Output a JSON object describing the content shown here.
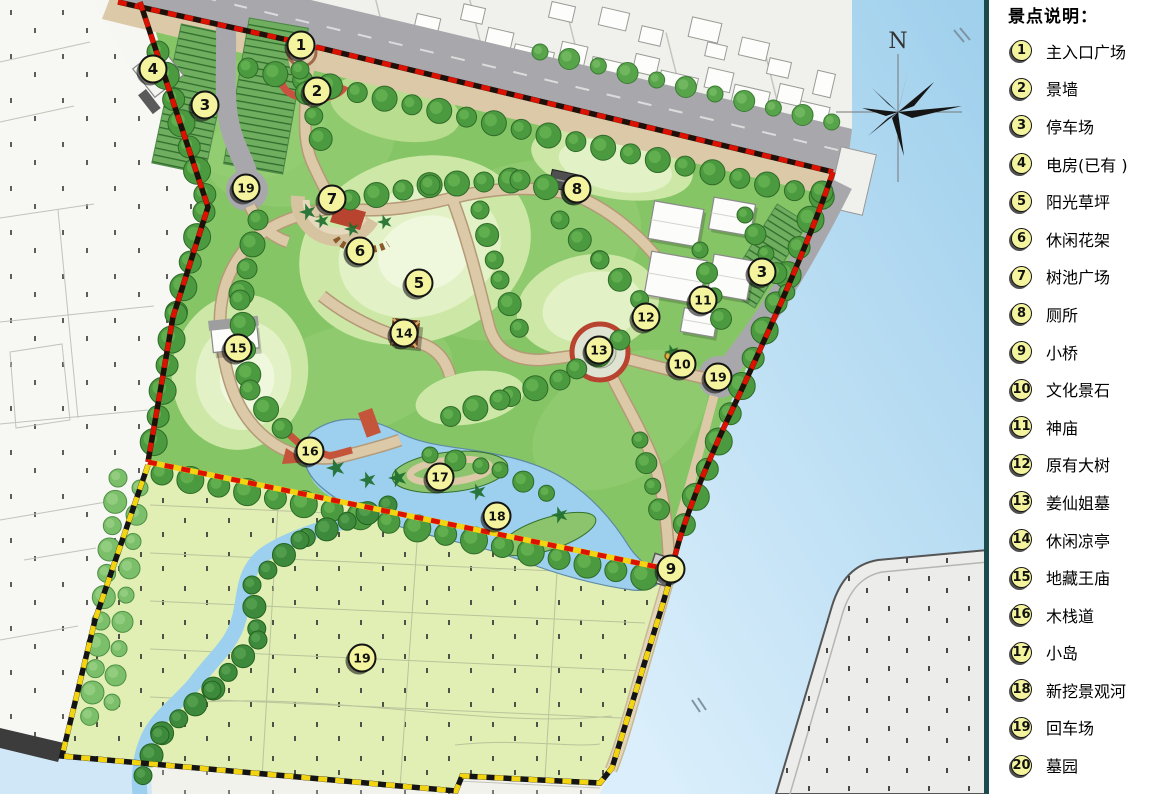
{
  "legend": {
    "title": "景点说明：",
    "items": [
      {
        "num": "1",
        "label": "主入口广场"
      },
      {
        "num": "2",
        "label": "景墙"
      },
      {
        "num": "3",
        "label": "停车场"
      },
      {
        "num": "4",
        "label": "电房(已有 )"
      },
      {
        "num": "5",
        "label": "阳光草坪"
      },
      {
        "num": "6",
        "label": "休闲花架"
      },
      {
        "num": "7",
        "label": "树池广场"
      },
      {
        "num": "8",
        "label": "厕所"
      },
      {
        "num": "9",
        "label": "小桥"
      },
      {
        "num": "10",
        "label": "文化景石"
      },
      {
        "num": "11",
        "label": "神庙"
      },
      {
        "num": "12",
        "label": "原有大树"
      },
      {
        "num": "13",
        "label": "姜仙姐墓"
      },
      {
        "num": "14",
        "label": "休闲凉亭"
      },
      {
        "num": "15",
        "label": "地藏王庙"
      },
      {
        "num": "16",
        "label": "木栈道"
      },
      {
        "num": "17",
        "label": "小岛"
      },
      {
        "num": "18",
        "label": "新挖景观河"
      },
      {
        "num": "19",
        "label": "回车场"
      },
      {
        "num": "20",
        "label": "墓园"
      }
    ]
  },
  "map": {
    "compass_label": "N",
    "markers": [
      {
        "num": "1",
        "x": 301,
        "y": 45
      },
      {
        "num": "2",
        "x": 317,
        "y": 91
      },
      {
        "num": "3",
        "x": 205,
        "y": 105
      },
      {
        "num": "4",
        "x": 153,
        "y": 69
      },
      {
        "num": "19",
        "x": 246,
        "y": 188
      },
      {
        "num": "7",
        "x": 332,
        "y": 199
      },
      {
        "num": "8",
        "x": 577,
        "y": 189
      },
      {
        "num": "6",
        "x": 360,
        "y": 251
      },
      {
        "num": "5",
        "x": 419,
        "y": 283
      },
      {
        "num": "3",
        "x": 762,
        "y": 272
      },
      {
        "num": "11",
        "x": 703,
        "y": 300
      },
      {
        "num": "12",
        "x": 646,
        "y": 317
      },
      {
        "num": "14",
        "x": 404,
        "y": 333
      },
      {
        "num": "13",
        "x": 599,
        "y": 350
      },
      {
        "num": "10",
        "x": 682,
        "y": 364
      },
      {
        "num": "19",
        "x": 718,
        "y": 377
      },
      {
        "num": "15",
        "x": 238,
        "y": 348
      },
      {
        "num": "16",
        "x": 310,
        "y": 451
      },
      {
        "num": "17",
        "x": 440,
        "y": 477
      },
      {
        "num": "18",
        "x": 497,
        "y": 516
      },
      {
        "num": "9",
        "x": 671,
        "y": 569
      },
      {
        "num": "19",
        "x": 362,
        "y": 658
      }
    ],
    "colors": {
      "boundary_red": "#dd1100",
      "boundary_yellow": "#f2d411",
      "marker_fill": "#f4f49e",
      "water": "#a9d5ef",
      "park_green": "#86c566",
      "cemetery_green": "#e1efb5",
      "road_grey": "#a8a8ac",
      "path_tan": "#dcc9a8"
    }
  }
}
